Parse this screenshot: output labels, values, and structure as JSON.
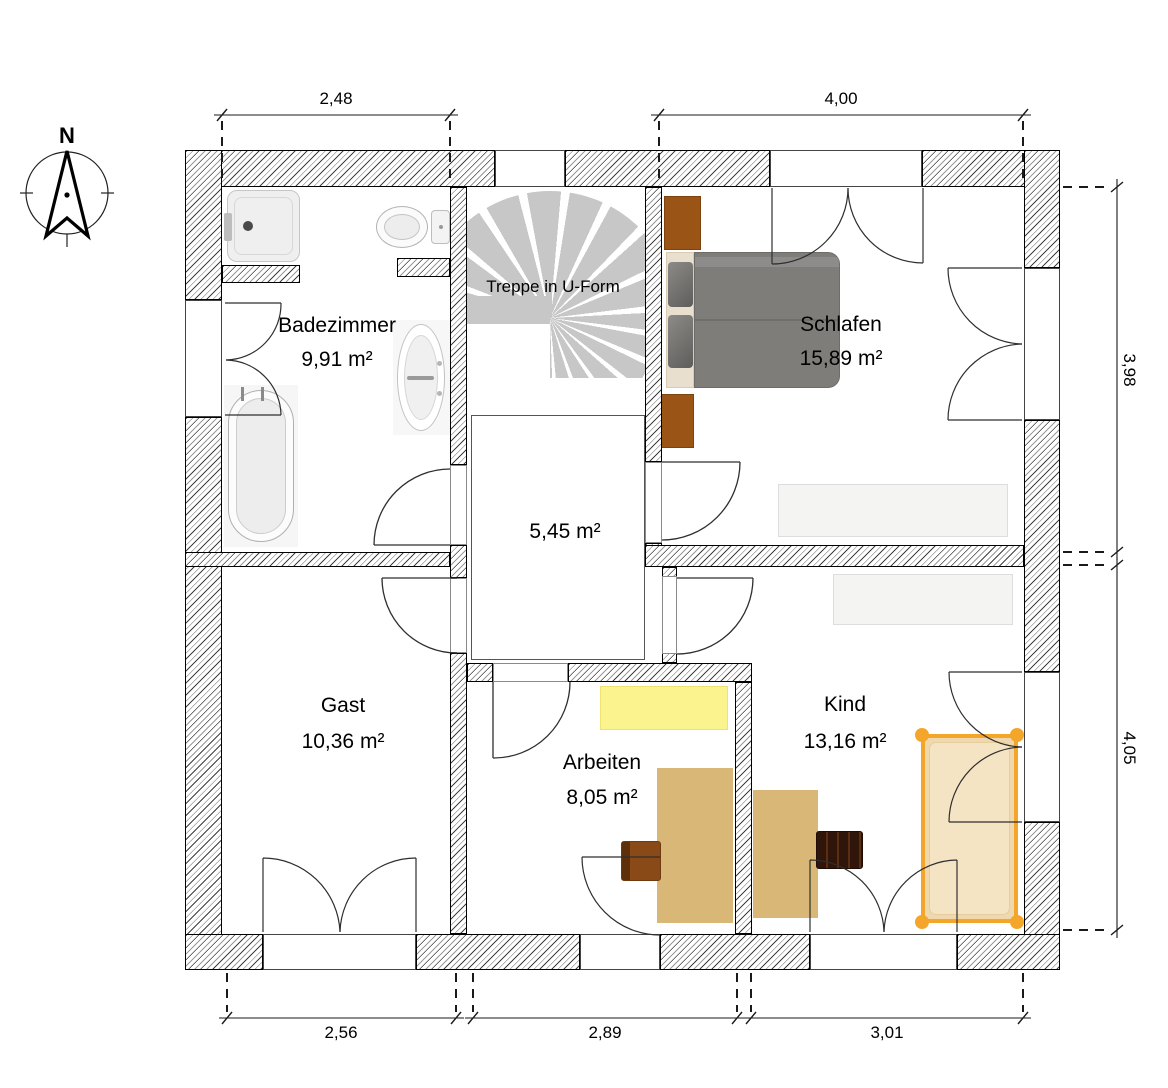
{
  "compass": {
    "north_label": "N"
  },
  "stairs": {
    "label": "Treppe in U-Form"
  },
  "rooms": [
    {
      "name": "Badezimmer",
      "area": "9,91 m²"
    },
    {
      "name": "Schlafen",
      "area": "15,89 m²"
    },
    {
      "name": "",
      "area": "5,45 m²"
    },
    {
      "name": "Gast",
      "area": "10,36 m²"
    },
    {
      "name": "Arbeiten",
      "area": "8,05 m²"
    },
    {
      "name": "Kind",
      "area": "13,16 m²"
    }
  ],
  "dimensions": {
    "top_left": "2,48",
    "top_right": "4,00",
    "right_upper": "3,98",
    "right_lower": "4,05",
    "bottom_left": "2,56",
    "bottom_middle": "2,89",
    "bottom_right": "3,01"
  },
  "selection": {
    "item": "kind-bed",
    "color": "#f4a62a"
  },
  "furniture": {
    "badezimmer": [
      "shower",
      "toilet",
      "washbasin",
      "bathtub"
    ],
    "schlafen": [
      "double-bed",
      "nightstand",
      "nightstand",
      "wardrobe"
    ],
    "arbeiten": [
      "sideboard",
      "desk",
      "chair"
    ],
    "kind": [
      "wardrobe",
      "desk",
      "chair",
      "bed"
    ]
  },
  "colors": {
    "wall_hatch": "#3f3f3f",
    "stair_tread": "#c7c7c7",
    "selection_orange": "#f4a62a",
    "desk_tan": "#d9b877",
    "bed_gray": "#7f7d7a",
    "nightstand_brown": "#9a5416",
    "sideboard_yellow": "#fbf38d",
    "chair_brown": "#8a4a17",
    "chair_dark": "#30160a"
  }
}
